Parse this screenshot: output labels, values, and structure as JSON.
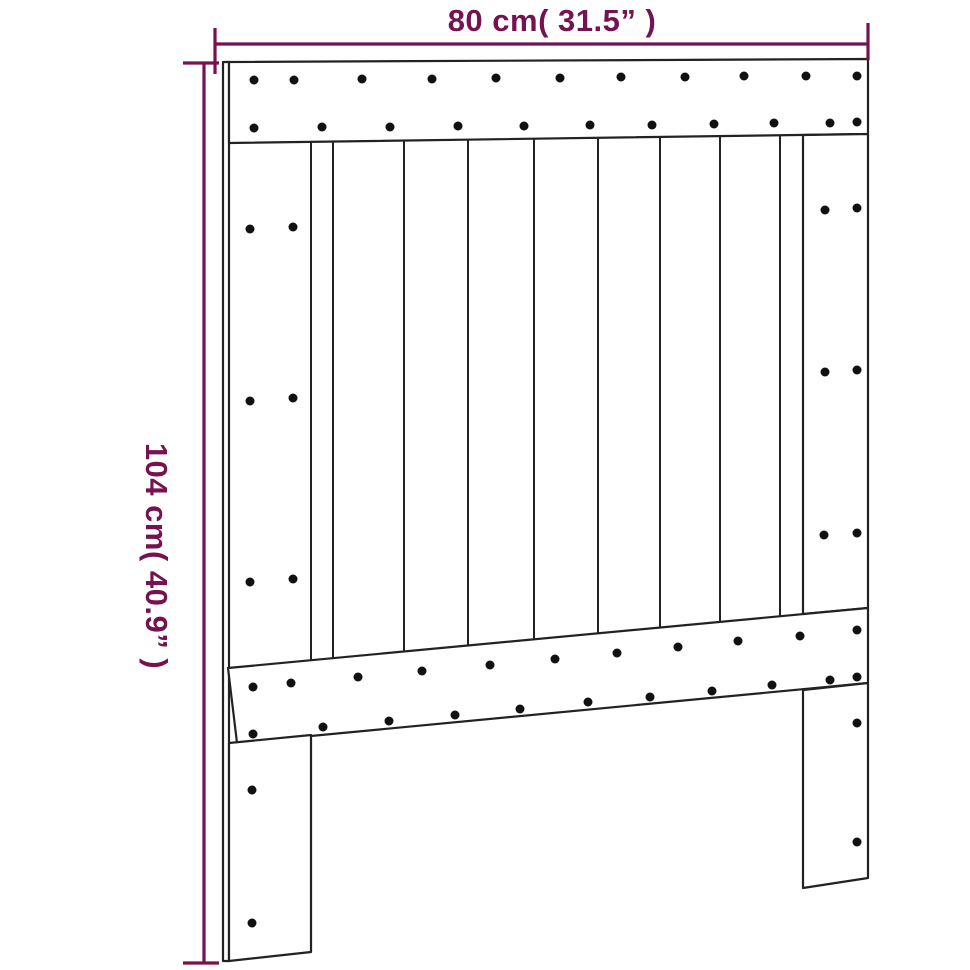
{
  "page": {
    "background": "#ffffff"
  },
  "colors": {
    "dimension": "#75124f",
    "line": "#222222",
    "dot": "#111111",
    "board_fill": "#ffffff"
  },
  "labels": {
    "width": "80 cm( 31.5” )",
    "height": "104 cm( 40.9” )"
  },
  "diagram": {
    "viewbox": "0 0 970 970",
    "screw_radius": 4.5,
    "boards": [
      {
        "name": "left-side-strip",
        "points": "223,62 229,62 229,961 223,961"
      },
      {
        "name": "top-rail",
        "points": "229,62 868,59 868,134 229,143"
      },
      {
        "name": "right-stile",
        "points": "803,135 868,134 868,608 803,614"
      },
      {
        "name": "bottom-rail",
        "points": "228,668 868,608 868,683 237,743"
      },
      {
        "name": "left-leg",
        "points": "229,743 311,735 311,952 229,961"
      },
      {
        "name": "right-leg",
        "points": "803,690 868,683 868,878 803,888"
      }
    ],
    "slats": [
      {
        "x": 311,
        "y1": 142,
        "y2": 660
      },
      {
        "x": 333,
        "y1": 142,
        "y2": 658
      },
      {
        "x": 404,
        "y1": 141,
        "y2": 652
      },
      {
        "x": 468,
        "y1": 140,
        "y2": 646
      },
      {
        "x": 534,
        "y1": 139,
        "y2": 639
      },
      {
        "x": 598,
        "y1": 138,
        "y2": 633
      },
      {
        "x": 660,
        "y1": 137,
        "y2": 628
      },
      {
        "x": 720,
        "y1": 136,
        "y2": 622
      },
      {
        "x": 780,
        "y1": 135,
        "y2": 616
      }
    ],
    "screws": [
      {
        "group": "top-rail-upper-row",
        "points": [
          [
            254,
            80
          ],
          [
            294,
            80
          ],
          [
            362,
            79
          ],
          [
            432,
            79
          ],
          [
            496,
            78
          ],
          [
            560,
            78
          ],
          [
            621,
            77
          ],
          [
            685,
            77
          ],
          [
            744,
            76
          ],
          [
            806,
            76
          ],
          [
            857,
            76
          ]
        ]
      },
      {
        "group": "top-rail-lower-row",
        "points": [
          [
            254,
            128
          ],
          [
            322,
            127
          ],
          [
            390,
            127
          ],
          [
            458,
            126
          ],
          [
            524,
            126
          ],
          [
            590,
            125
          ],
          [
            652,
            125
          ],
          [
            714,
            124
          ],
          [
            774,
            123
          ],
          [
            830,
            123
          ],
          [
            857,
            122
          ]
        ]
      },
      {
        "group": "left-stile-screws",
        "points": [
          [
            250,
            229
          ],
          [
            293,
            227
          ],
          [
            250,
            401
          ],
          [
            293,
            398
          ],
          [
            250,
            582
          ],
          [
            293,
            579
          ]
        ]
      },
      {
        "group": "right-stile-screws",
        "points": [
          [
            825,
            210
          ],
          [
            857,
            208
          ],
          [
            825,
            372
          ],
          [
            857,
            370
          ],
          [
            824,
            535
          ],
          [
            857,
            533
          ]
        ]
      },
      {
        "group": "bottom-rail-upper-row",
        "points": [
          [
            253,
            687
          ],
          [
            291,
            683
          ],
          [
            358,
            677
          ],
          [
            422,
            671
          ],
          [
            490,
            665
          ],
          [
            555,
            659
          ],
          [
            617,
            653
          ],
          [
            678,
            647
          ],
          [
            738,
            641
          ],
          [
            800,
            636
          ],
          [
            857,
            630
          ]
        ]
      },
      {
        "group": "bottom-rail-lower-row",
        "points": [
          [
            253,
            734
          ],
          [
            323,
            727
          ],
          [
            389,
            721
          ],
          [
            455,
            715
          ],
          [
            520,
            709
          ],
          [
            588,
            702
          ],
          [
            650,
            697
          ],
          [
            712,
            691
          ],
          [
            772,
            685
          ],
          [
            830,
            680
          ],
          [
            857,
            677
          ]
        ]
      },
      {
        "group": "left-leg-screws",
        "points": [
          [
            252,
            790
          ],
          [
            252,
            923
          ]
        ]
      },
      {
        "group": "right-leg-screws",
        "points": [
          [
            857,
            723
          ],
          [
            857,
            842
          ]
        ]
      }
    ],
    "dimension_lines": [
      {
        "name": "width-dim-line",
        "x1": 215,
        "y1": 44,
        "x2": 868,
        "y2": 44
      },
      {
        "name": "width-dim-tick-left",
        "x1": 215,
        "y1": 28,
        "x2": 215,
        "y2": 74
      },
      {
        "name": "width-dim-tick-right",
        "x1": 868,
        "y1": 23,
        "x2": 868,
        "y2": 60
      },
      {
        "name": "height-dim-line",
        "x1": 204,
        "y1": 63,
        "x2": 204,
        "y2": 963
      },
      {
        "name": "height-dim-tick-top",
        "x1": 183,
        "y1": 63,
        "x2": 219,
        "y2": 63
      },
      {
        "name": "height-dim-tick-bottom",
        "x1": 183,
        "y1": 963,
        "x2": 219,
        "y2": 963
      }
    ]
  }
}
